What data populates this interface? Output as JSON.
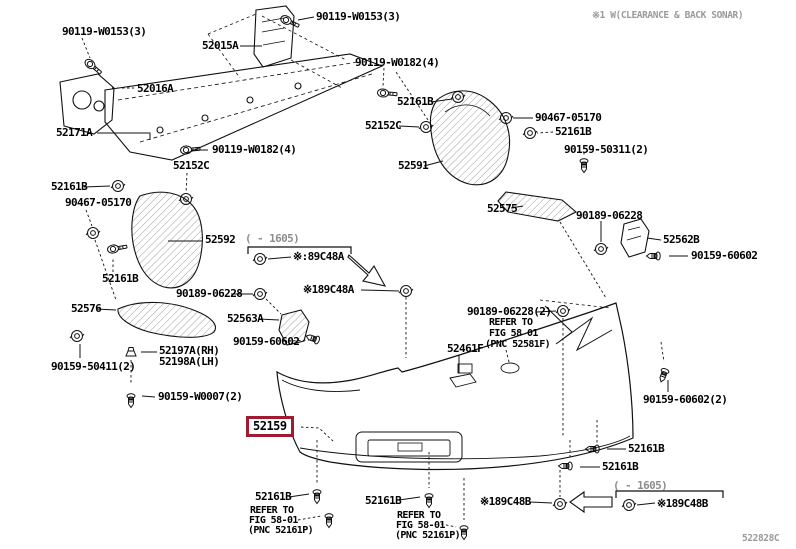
{
  "page": {
    "top_note": "※1 W(CLEARANCE & BACK SONAR)",
    "diagram_code": "522828C",
    "colors": {
      "highlight_box": "#9e1b32",
      "line": "#111111",
      "note_gray": "#9a9a9a"
    }
  },
  "selected_part": {
    "text": "52159",
    "x": 246,
    "y": 416
  },
  "labels": [
    {
      "t": "90119-W0153(3)",
      "x": 62,
      "y": 26
    },
    {
      "t": "90119-W0153(3)",
      "x": 316,
      "y": 11
    },
    {
      "t": "52015A",
      "x": 202,
      "y": 40
    },
    {
      "t": "52016A",
      "x": 137,
      "y": 83
    },
    {
      "t": "52171A",
      "x": 56,
      "y": 127
    },
    {
      "t": "90119-W0182(4)",
      "x": 212,
      "y": 144
    },
    {
      "t": "90119-W0182(4)",
      "x": 355,
      "y": 57
    },
    {
      "t": "52161B",
      "x": 397,
      "y": 96
    },
    {
      "t": "52152C",
      "x": 365,
      "y": 120
    },
    {
      "t": "90467-05170",
      "x": 535,
      "y": 112
    },
    {
      "t": "52161B",
      "x": 555,
      "y": 126
    },
    {
      "t": "90159-50311(2)",
      "x": 564,
      "y": 144
    },
    {
      "t": "52591",
      "x": 398,
      "y": 160
    },
    {
      "t": "52152C",
      "x": 173,
      "y": 160
    },
    {
      "t": "52161B",
      "x": 51,
      "y": 181
    },
    {
      "t": "90467-05170",
      "x": 65,
      "y": 197
    },
    {
      "t": "52592",
      "x": 205,
      "y": 234
    },
    {
      "t": "52161B",
      "x": 102,
      "y": 273
    },
    {
      "t": "52575",
      "x": 487,
      "y": 203
    },
    {
      "t": "90189-06228",
      "x": 576,
      "y": 210
    },
    {
      "t": "52562B",
      "x": 663,
      "y": 234
    },
    {
      "t": "90159-60602",
      "x": 691,
      "y": 250
    },
    {
      "t": "( - 1605)",
      "x": 245,
      "y": 233,
      "kind": "dim"
    },
    {
      "t": "※:89C48A",
      "x": 293,
      "y": 251
    },
    {
      "t": "※189C48A",
      "x": 303,
      "y": 284
    },
    {
      "t": "90189-06228",
      "x": 176,
      "y": 288
    },
    {
      "t": "52576",
      "x": 71,
      "y": 303
    },
    {
      "t": "52563A",
      "x": 227,
      "y": 313
    },
    {
      "t": "90159-60602",
      "x": 233,
      "y": 336
    },
    {
      "t": "90189-06228(2)",
      "x": 467,
      "y": 306
    },
    {
      "t": "REFER TO",
      "x": 489,
      "y": 317,
      "kind": "ref"
    },
    {
      "t": "FIG 58 01",
      "x": 489,
      "y": 328,
      "kind": "ref"
    },
    {
      "t": "(PNC 52581F)",
      "x": 485,
      "y": 339,
      "kind": "ref"
    },
    {
      "t": "52461F",
      "x": 447,
      "y": 343
    },
    {
      "t": "52197A(RH)",
      "x": 159,
      "y": 345
    },
    {
      "t": "52198A(LH)",
      "x": 159,
      "y": 356
    },
    {
      "t": "90159-50411(2)",
      "x": 51,
      "y": 361
    },
    {
      "t": "90159-W0007(2)",
      "x": 158,
      "y": 391
    },
    {
      "t": "90159-60602(2)",
      "x": 643,
      "y": 394
    },
    {
      "t": "52161B",
      "x": 628,
      "y": 443
    },
    {
      "t": "52161B",
      "x": 602,
      "y": 461
    },
    {
      "t": "52161B",
      "x": 255,
      "y": 491
    },
    {
      "t": "REFER TO",
      "x": 250,
      "y": 505,
      "kind": "ref"
    },
    {
      "t": "FIG 58-01",
      "x": 249,
      "y": 515,
      "kind": "ref"
    },
    {
      "t": "(PNC 52161P)",
      "x": 248,
      "y": 525,
      "kind": "ref"
    },
    {
      "t": "52161B",
      "x": 365,
      "y": 495
    },
    {
      "t": "REFER TO",
      "x": 397,
      "y": 510,
      "kind": "ref"
    },
    {
      "t": "FIG 58-01",
      "x": 396,
      "y": 520,
      "kind": "ref"
    },
    {
      "t": "(PNC 52161P)",
      "x": 395,
      "y": 530,
      "kind": "ref"
    },
    {
      "t": "※189C48B",
      "x": 480,
      "y": 496
    },
    {
      "t": "( - 1605)",
      "x": 613,
      "y": 480,
      "kind": "dim"
    },
    {
      "t": "※189C48B",
      "x": 657,
      "y": 498
    }
  ],
  "fasteners": [
    {
      "type": "bolt",
      "x": 90,
      "y": 64,
      "r": 40
    },
    {
      "type": "bolt",
      "x": 286,
      "y": 20,
      "r": 25
    },
    {
      "type": "bolt",
      "x": 383,
      "y": 93,
      "r": 5
    },
    {
      "type": "bolt",
      "x": 186,
      "y": 150,
      "r": -5
    },
    {
      "type": "bolt",
      "x": 113,
      "y": 249,
      "r": -10
    },
    {
      "type": "clip",
      "x": 458,
      "y": 97
    },
    {
      "type": "clip",
      "x": 426,
      "y": 127
    },
    {
      "type": "clip",
      "x": 506,
      "y": 118
    },
    {
      "type": "clip",
      "x": 530,
      "y": 133
    },
    {
      "type": "clip",
      "x": 186,
      "y": 199
    },
    {
      "type": "clip",
      "x": 118,
      "y": 186
    },
    {
      "type": "clip",
      "x": 93,
      "y": 233
    },
    {
      "type": "clip",
      "x": 601,
      "y": 249
    },
    {
      "type": "clip",
      "x": 260,
      "y": 294
    },
    {
      "type": "clip",
      "x": 563,
      "y": 311
    },
    {
      "type": "clip",
      "x": 260,
      "y": 259
    },
    {
      "type": "clip",
      "x": 406,
      "y": 291
    },
    {
      "type": "clip",
      "x": 560,
      "y": 504
    },
    {
      "type": "clip",
      "x": 629,
      "y": 505
    },
    {
      "type": "clip",
      "x": 77,
      "y": 336
    },
    {
      "type": "screw",
      "x": 584,
      "y": 161,
      "r": 0
    },
    {
      "type": "screw",
      "x": 658,
      "y": 256,
      "r": 90
    },
    {
      "type": "screw",
      "x": 317,
      "y": 340,
      "r": 110
    },
    {
      "type": "screw",
      "x": 131,
      "y": 396,
      "r": 0
    },
    {
      "type": "screw",
      "x": 665,
      "y": 371,
      "r": 20
    },
    {
      "type": "screw",
      "x": 597,
      "y": 449,
      "r": 90
    },
    {
      "type": "screw",
      "x": 570,
      "y": 466,
      "r": 90
    },
    {
      "type": "screw",
      "x": 317,
      "y": 492,
      "r": 0
    },
    {
      "type": "screw",
      "x": 329,
      "y": 516,
      "r": 0
    },
    {
      "type": "screw",
      "x": 429,
      "y": 496,
      "r": 0
    },
    {
      "type": "screw",
      "x": 464,
      "y": 528,
      "r": 0
    },
    {
      "type": "grommet",
      "x": 131,
      "y": 352,
      "r": 0
    }
  ]
}
